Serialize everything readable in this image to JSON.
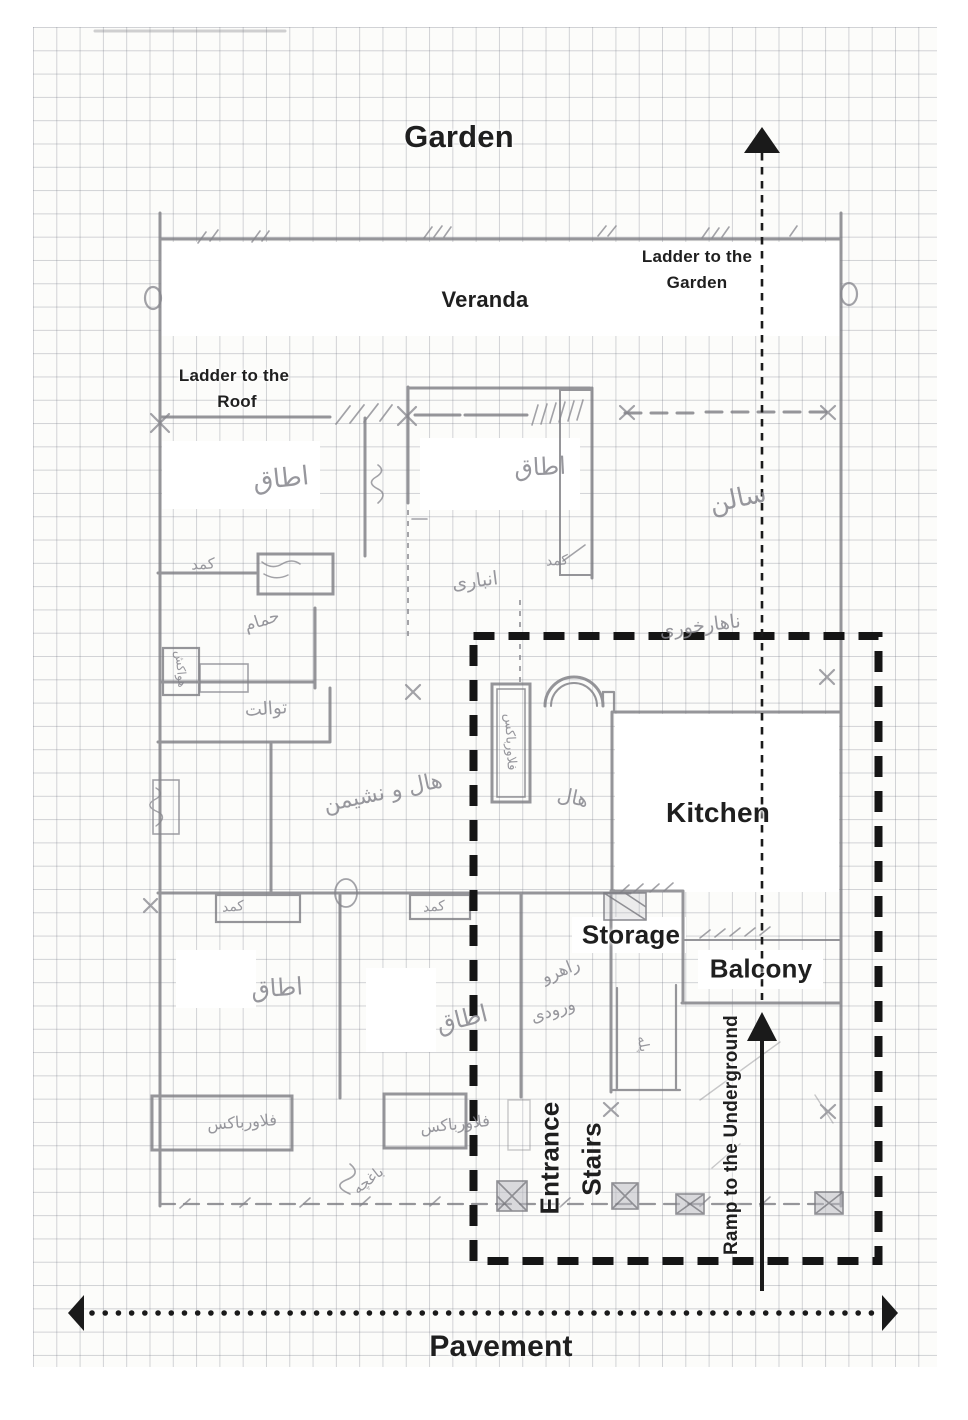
{
  "labels": {
    "garden": "Garden",
    "veranda": "Veranda",
    "ladder_to_garden_line1": "Ladder to the",
    "ladder_to_garden_line2": "Garden",
    "ladder_to_roof_line1": "Ladder to the",
    "ladder_to_roof_line2": "Roof",
    "kitchen": "Kitchen",
    "storage": "Storage",
    "balcony": "Balcony",
    "entrance": "Entrance",
    "stairs": "Stairs",
    "ramp": "Ramp to the Underground",
    "pavement": "Pavement"
  },
  "persian": [
    "اطاق",
    "اطاق",
    "سالن",
    "کمد",
    "کمد",
    "انباری",
    "حمام",
    "هواکش",
    "توالت",
    "ناهارخوری",
    "هال و نشیمن",
    "هال",
    "فلاورباکس",
    "کمد",
    "کمد",
    "اطاق",
    "اطاق",
    "راهرو",
    "ورودی",
    "پله",
    "فلاورباکس",
    "فلاورباکس",
    "باغچه"
  ],
  "colors": {
    "ink": "#1a1a1a",
    "pencil": "#7c7c82",
    "paper": "#fcfcfa"
  }
}
